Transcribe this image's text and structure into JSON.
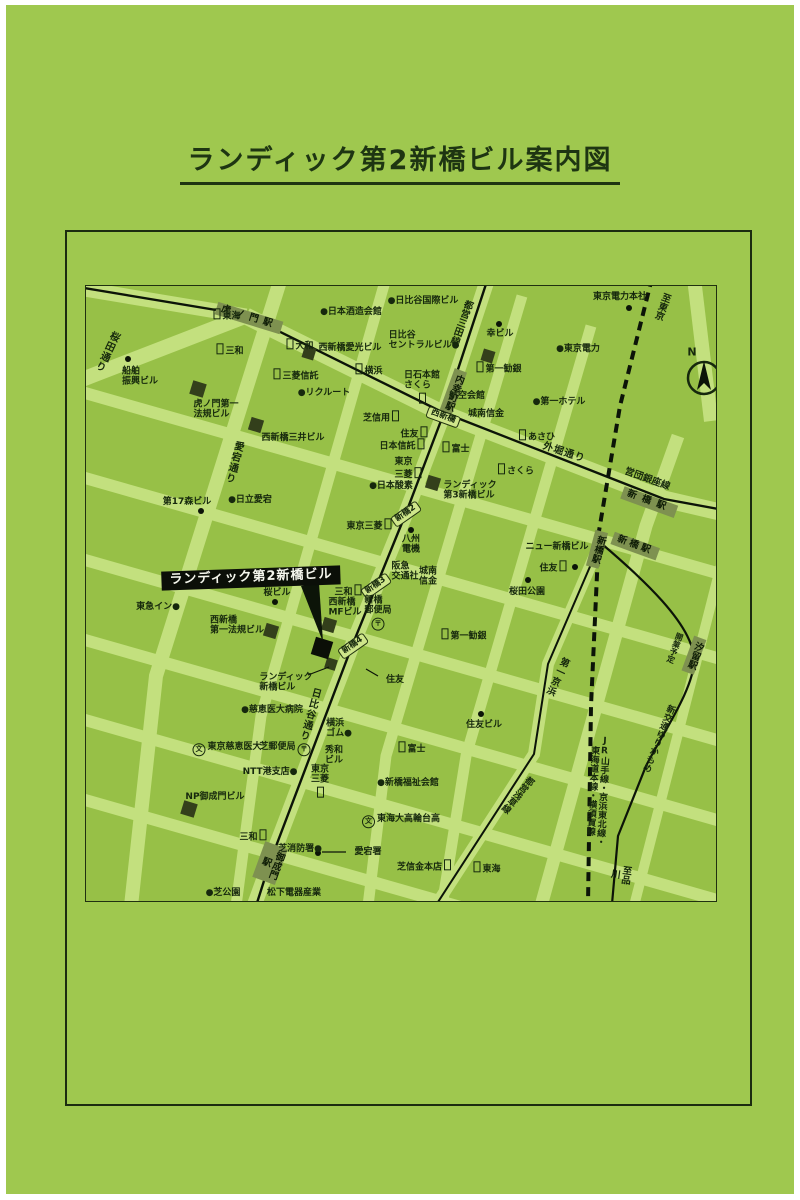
{
  "page": {
    "title": "ランディック第2新橋ビル案内図"
  },
  "map": {
    "icons": {
      "post": "〒",
      "school": "文",
      "bank": ""
    },
    "labels": [
      {
        "t": "虎ノ門駅",
        "x": 163,
        "y": 32,
        "r": 17,
        "k": "st",
        "ls": 5,
        "name": "station-toranomon"
      },
      {
        "t": "桜田通り",
        "x": 20,
        "y": 65,
        "v": 1,
        "r": 25,
        "k": "sn",
        "name": "street-sakurada-dori"
      },
      {
        "t": "東海",
        "x": 140,
        "y": 29,
        "icon": "bank",
        "ip": "before"
      },
      {
        "t": "●日本酒造会館",
        "x": 265,
        "y": 26
      },
      {
        "t": "●日比谷国際ビル",
        "x": 337,
        "y": 15
      },
      {
        "t": "三和",
        "x": 143,
        "y": 64,
        "icon": "bank",
        "ip": "before"
      },
      {
        "t": "大和",
        "x": 213,
        "y": 59,
        "icon": "bank",
        "ip": "before"
      },
      {
        "t": "西新橋愛光ビル",
        "x": 264,
        "y": 62
      },
      {
        "t": "日比谷\nセントラルビル●",
        "x": 338,
        "y": 55,
        "al": "left"
      },
      {
        "t": "横浜",
        "x": 282,
        "y": 84,
        "icon": "bank",
        "ip": "before"
      },
      {
        "t": "三菱信託",
        "x": 209,
        "y": 89,
        "icon": "bank",
        "ip": "before"
      },
      {
        "t": "船舶\n振興ビル",
        "x": 54,
        "y": 91,
        "al": "left"
      },
      {
        "t": "●リクルート",
        "x": 238,
        "y": 107
      },
      {
        "t": "虎ノ門第一\n法規ビル",
        "x": 130,
        "y": 124,
        "al": "left"
      },
      {
        "t": "西新橋三井ビル",
        "x": 207,
        "y": 152
      },
      {
        "t": "芝信用",
        "x": 296,
        "y": 131,
        "icon": "bank",
        "ip": "after"
      },
      {
        "t": "都営三田線",
        "x": 374,
        "y": 36,
        "v": 1,
        "r": 20,
        "k": "rn",
        "name": "rail-toei-mita-line"
      },
      {
        "t": "内幸町駅",
        "x": 367,
        "y": 106,
        "v": 1,
        "r": 20,
        "k": "st",
        "name": "station-uchisaiwaicho"
      },
      {
        "t": "幸ビル",
        "x": 414,
        "y": 48
      },
      {
        "t": "東京電力本社",
        "x": 534,
        "y": 11
      },
      {
        "t": "至東京",
        "x": 575,
        "y": 20,
        "v": 1,
        "r": 20,
        "k": "dir",
        "name": "direction-to-tokyo"
      },
      {
        "t": "●東京電力",
        "x": 492,
        "y": 63
      },
      {
        "t": "第一勧銀",
        "x": 412,
        "y": 82,
        "icon": "bank",
        "ip": "before"
      },
      {
        "t": "日石本館\nさくら",
        "x": 336,
        "y": 101,
        "al": "left",
        "icon": "bank",
        "ip": "below"
      },
      {
        "t": "航空会館",
        "x": 381,
        "y": 110
      },
      {
        "t": "城南信金",
        "x": 400,
        "y": 128
      },
      {
        "t": "●第一ホテル",
        "x": 473,
        "y": 116
      },
      {
        "t": "あさひ",
        "x": 450,
        "y": 150,
        "icon": "bank",
        "ip": "before"
      },
      {
        "t": "外堀通り",
        "x": 478,
        "y": 167,
        "r": 18,
        "k": "sn",
        "name": "street-sotobori-dori"
      },
      {
        "t": "西新橋",
        "x": 357,
        "y": 131,
        "r": 20,
        "k": "ix",
        "name": "intersection-nishishimbashi"
      },
      {
        "t": "住友",
        "x": 329,
        "y": 147,
        "icon": "bank",
        "ip": "after"
      },
      {
        "t": "日本信託",
        "x": 317,
        "y": 159,
        "icon": "bank",
        "ip": "after"
      },
      {
        "t": "富士",
        "x": 369,
        "y": 162,
        "icon": "bank",
        "ip": "before"
      },
      {
        "t": "さくら",
        "x": 429,
        "y": 184,
        "icon": "bank",
        "ip": "before"
      },
      {
        "t": "東京\n三菱",
        "x": 323,
        "y": 183,
        "al": "left",
        "icon": "bank",
        "ip": "after"
      },
      {
        "t": "●日本酸素",
        "x": 305,
        "y": 200
      },
      {
        "t": "ランディック\n第3新橋ビル",
        "x": 384,
        "y": 205,
        "al": "left"
      },
      {
        "t": "新橋2",
        "x": 320,
        "y": 228,
        "r": -35,
        "k": "ix",
        "name": "intersection-shimbashi-2"
      },
      {
        "t": "東京三菱",
        "x": 284,
        "y": 239,
        "icon": "bank",
        "ip": "after"
      },
      {
        "t": "八州\n電機",
        "x": 325,
        "y": 259,
        "al": "left"
      },
      {
        "t": "阪急\n交通社",
        "x": 319,
        "y": 286,
        "al": "left"
      },
      {
        "t": "城南\n信金",
        "x": 342,
        "y": 291,
        "al": "left"
      },
      {
        "t": "ニュー新橋ビル",
        "x": 471,
        "y": 261
      },
      {
        "t": "住友",
        "x": 468,
        "y": 281,
        "icon": "bank",
        "ip": "after"
      },
      {
        "t": "桜田公園",
        "x": 441,
        "y": 306,
        "name": "sakurada-park"
      },
      {
        "t": "営団銀座線",
        "x": 561,
        "y": 194,
        "r": 20,
        "k": "rn",
        "name": "rail-eidan-ginza-line"
      },
      {
        "t": "新橋駅",
        "x": 563,
        "y": 216,
        "r": 20,
        "k": "st",
        "ls": 6,
        "name": "station-shimbashi-ginza"
      },
      {
        "t": "新橋駅",
        "x": 511,
        "y": 263,
        "v": 1,
        "r": 15,
        "k": "st",
        "name": "station-shimbashi-jr"
      },
      {
        "t": "新橋駅",
        "x": 549,
        "y": 260,
        "r": 20,
        "k": "st",
        "ls": 3,
        "name": "station-shimbashi-2"
      },
      {
        "t": "汐留駅",
        "x": 608,
        "y": 369,
        "v": 1,
        "r": 20,
        "k": "st",
        "name": "station-shiodome"
      },
      {
        "t": "開業予定",
        "x": 589,
        "y": 362,
        "v": 1,
        "r": 20,
        "s": 8
      },
      {
        "t": "新交通ゆりかもめ",
        "x": 572,
        "y": 452,
        "v": 1,
        "r": 22,
        "k": "rn",
        "s": 9,
        "name": "rail-yurikamome"
      },
      {
        "t": "JR山手線・京浜東北線・東海道本線・横須賀線",
        "x": 511,
        "y": 505,
        "v": 1,
        "r": 3,
        "k": "rn",
        "s": 9,
        "name": "rail-jr-lines"
      },
      {
        "t": "第一京浜",
        "x": 470,
        "y": 390,
        "v": 1,
        "r": 25,
        "k": "sn",
        "s": 9.5,
        "name": "street-daiichi-keihin"
      },
      {
        "t": "都営浅草線",
        "x": 431,
        "y": 508,
        "v": 1,
        "r": 40,
        "k": "rn",
        "s": 9,
        "name": "rail-toei-asakusa-line"
      },
      {
        "t": "至品川",
        "x": 533,
        "y": 588,
        "v": 1,
        "r": 8,
        "k": "dir",
        "name": "direction-to-shinagawa"
      },
      {
        "t": "ランディック第2新橋ビル",
        "x": 165,
        "y": 292,
        "r": -2,
        "k": "bn",
        "name": "subject-building-banner"
      },
      {
        "t": "桜ビル",
        "x": 191,
        "y": 307
      },
      {
        "t": "東急イン●",
        "x": 72,
        "y": 321
      },
      {
        "t": "三和",
        "x": 263,
        "y": 305,
        "icon": "bank",
        "ip": "after"
      },
      {
        "t": "西新橋\nMFビル",
        "x": 259,
        "y": 322,
        "al": "left"
      },
      {
        "t": "新橋3",
        "x": 290,
        "y": 300,
        "r": -35,
        "k": "ix",
        "name": "intersection-shimbashi-3"
      },
      {
        "t": "西新橋\n第一法規ビル",
        "x": 151,
        "y": 340,
        "al": "left"
      },
      {
        "t": "新橋4",
        "x": 267,
        "y": 360,
        "r": -35,
        "k": "ix",
        "name": "intersection-shimbashi-4"
      },
      {
        "t": "新橋\n郵便局",
        "x": 292,
        "y": 327,
        "al": "left",
        "icon": "post",
        "ip": "below",
        "name": "shimbashi-post-office"
      },
      {
        "t": "ランディック\n新橋ビル",
        "x": 200,
        "y": 397,
        "al": "left",
        "name": "landic-shimbashi-bldg-label"
      },
      {
        "t": "第一勧銀",
        "x": 377,
        "y": 349,
        "icon": "bank",
        "ip": "before"
      },
      {
        "t": "住友",
        "x": 309,
        "y": 394
      },
      {
        "t": "日比谷通り",
        "x": 223,
        "y": 428,
        "v": 1,
        "r": 15,
        "k": "sn",
        "name": "street-hibiya-dori"
      },
      {
        "t": "●慈恵医大病院",
        "x": 186,
        "y": 424
      },
      {
        "t": "住友ビル",
        "x": 398,
        "y": 439
      },
      {
        "t": "富士",
        "x": 325,
        "y": 462,
        "icon": "bank",
        "ip": "before"
      },
      {
        "t": "東京慈恵医大",
        "x": 140,
        "y": 463,
        "icon": "school",
        "ip": "before"
      },
      {
        "t": "芝郵便局",
        "x": 200,
        "y": 463,
        "icon": "post",
        "ip": "after",
        "name": "shiba-post-office"
      },
      {
        "t": "NTT港支店●",
        "x": 184,
        "y": 486
      },
      {
        "t": "横浜\nゴム●",
        "x": 253,
        "y": 443,
        "al": "left"
      },
      {
        "t": "秀和\nビル",
        "x": 248,
        "y": 470,
        "al": "left"
      },
      {
        "t": "東京\n三菱",
        "x": 234,
        "y": 495,
        "al": "left",
        "icon": "bank",
        "ip": "below"
      },
      {
        "t": "NP御成門ビル",
        "x": 129,
        "y": 511
      },
      {
        "t": "●新橋福祉会館",
        "x": 322,
        "y": 497
      },
      {
        "t": "東海大高輪台高",
        "x": 314,
        "y": 535,
        "icon": "school",
        "ip": "before"
      },
      {
        "t": "三和",
        "x": 168,
        "y": 550,
        "icon": "bank",
        "ip": "after"
      },
      {
        "t": "御成門駅",
        "x": 184,
        "y": 577,
        "v": 1,
        "r": 20,
        "k": "st",
        "name": "station-onarimon"
      },
      {
        "t": "芝消防署●",
        "x": 214,
        "y": 563
      },
      {
        "t": "愛宕署",
        "x": 282,
        "y": 566
      },
      {
        "t": "芝信金本店",
        "x": 339,
        "y": 580,
        "icon": "bank",
        "ip": "after"
      },
      {
        "t": "東海",
        "x": 400,
        "y": 582,
        "icon": "bank",
        "ip": "before"
      },
      {
        "t": "●芝公園",
        "x": 137,
        "y": 607
      },
      {
        "t": "松下電器産業",
        "x": 208,
        "y": 607
      },
      {
        "t": "愛宕通り",
        "x": 147,
        "y": 176,
        "v": 1,
        "r": 15,
        "k": "sn",
        "name": "street-atago-dori"
      },
      {
        "t": "第17森ビル",
        "x": 101,
        "y": 216
      },
      {
        "t": "●日立愛宕",
        "x": 164,
        "y": 214
      },
      {
        "t": "N",
        "x": 606,
        "y": 67,
        "s": 11,
        "name": "compass-n-label"
      }
    ]
  }
}
